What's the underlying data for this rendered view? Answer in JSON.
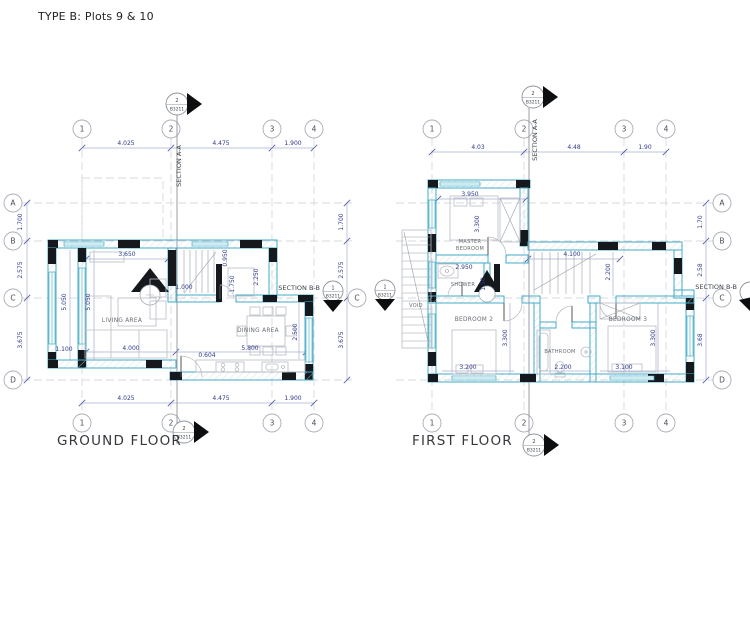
{
  "title": "TYPE B: Plots 9 & 10",
  "ground_floor": {
    "label": "GROUND FLOOR",
    "grid": {
      "cols": [
        "1",
        "2",
        "3",
        "4"
      ],
      "rows": [
        "A",
        "B",
        "C",
        "D"
      ],
      "col_dims": [
        "4.025",
        "4.475",
        "1.900"
      ],
      "row_dims": [
        "1.700",
        "2.575",
        "3.675"
      ]
    },
    "section_aa": {
      "num": "2",
      "ref": "B3211",
      "label": "SECTION A-A"
    },
    "section_bb": {
      "num": "1",
      "ref": "B3211",
      "label": "SECTION B-B"
    },
    "rooms": {
      "living": "LIVING AREA",
      "dining": "DINING AREA"
    },
    "dims": {
      "living_top": "3.650",
      "left_outer": "5.050",
      "left_inner": "5.050",
      "porch": "1.100",
      "living_bottom": "4.000",
      "stair_width": "1.000",
      "stair_top": "0.950",
      "stair_bottom": "1.750",
      "hall": "2.250",
      "dining_bottom": "5.800",
      "dining_side": "2.500",
      "entry_door": "0.604"
    }
  },
  "first_floor": {
    "label": "FIRST FLOOR",
    "grid": {
      "cols": [
        "1",
        "2",
        "3",
        "4"
      ],
      "rows": [
        "A",
        "B",
        "C",
        "D"
      ],
      "col_dims": [
        "4.03",
        "4.48",
        "1.90"
      ],
      "row_dims": [
        "1.70",
        "2.58",
        "3.68"
      ]
    },
    "section_aa": {
      "num": "2",
      "ref": "B3211",
      "label": "SECTION A-A"
    },
    "section_bb": {
      "num": "1",
      "ref": "B3211",
      "label": "SECTION B-B"
    },
    "rooms": {
      "master_1": "MASTER",
      "master_2": "BEDROOM",
      "shower": "SHOWER",
      "bed2": "BEDROOM 2",
      "bath": "BATHROOM",
      "bed3": "BEDROOM 3",
      "void": "VOID"
    },
    "dims": {
      "master_top": "3.950",
      "master_side": "3.300",
      "shower_top": "2.950",
      "shower_side": "1.50",
      "landing": "4.100",
      "stair_side": "2.200",
      "bed2_side": "3.300",
      "bed2_bottom": "3.200",
      "bath_bottom": "2.200",
      "bed3_side": "3.300",
      "bed3_bottom": "3.100"
    }
  }
}
